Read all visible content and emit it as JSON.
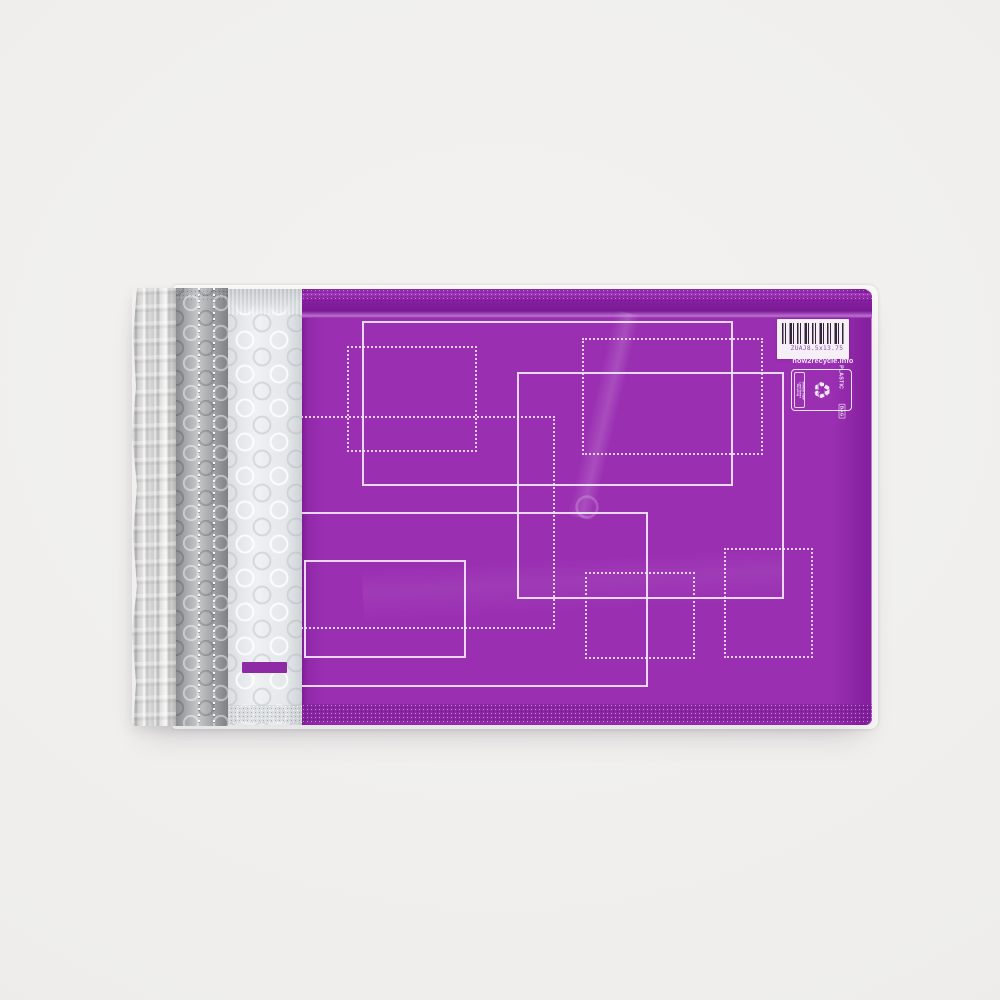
{
  "mailer": {
    "barcode": {
      "text": "ZUAJ8.5x13.75"
    },
    "recycle_label": {
      "url": "how2recycle.info",
      "qualifier_lines": [
        "Remove Paper",
        "Label Before",
        "Recycling"
      ],
      "symbol_icon": "recycling-arrows-icon",
      "symbol_lines": [
        "Store",
        "Drop-off"
      ],
      "material": "PLASTIC",
      "format": "BAG"
    },
    "colors": {
      "purple_face": "#9a2fb2",
      "purple_fold": "#7a1a94",
      "purple_dash": "#8e2aa6",
      "pattern_lines": "#f0e7f8",
      "foil_silver": "#d6d6d6",
      "gray_bubble_strip": "#9fa0a3",
      "white_bubble_strip": "#e9ebed",
      "barcode_label_bg": "#f4f0f6",
      "barcode_bars": "#35233b",
      "barcode_text": "#8d4aa8",
      "photo_background": "#efeeec"
    }
  }
}
